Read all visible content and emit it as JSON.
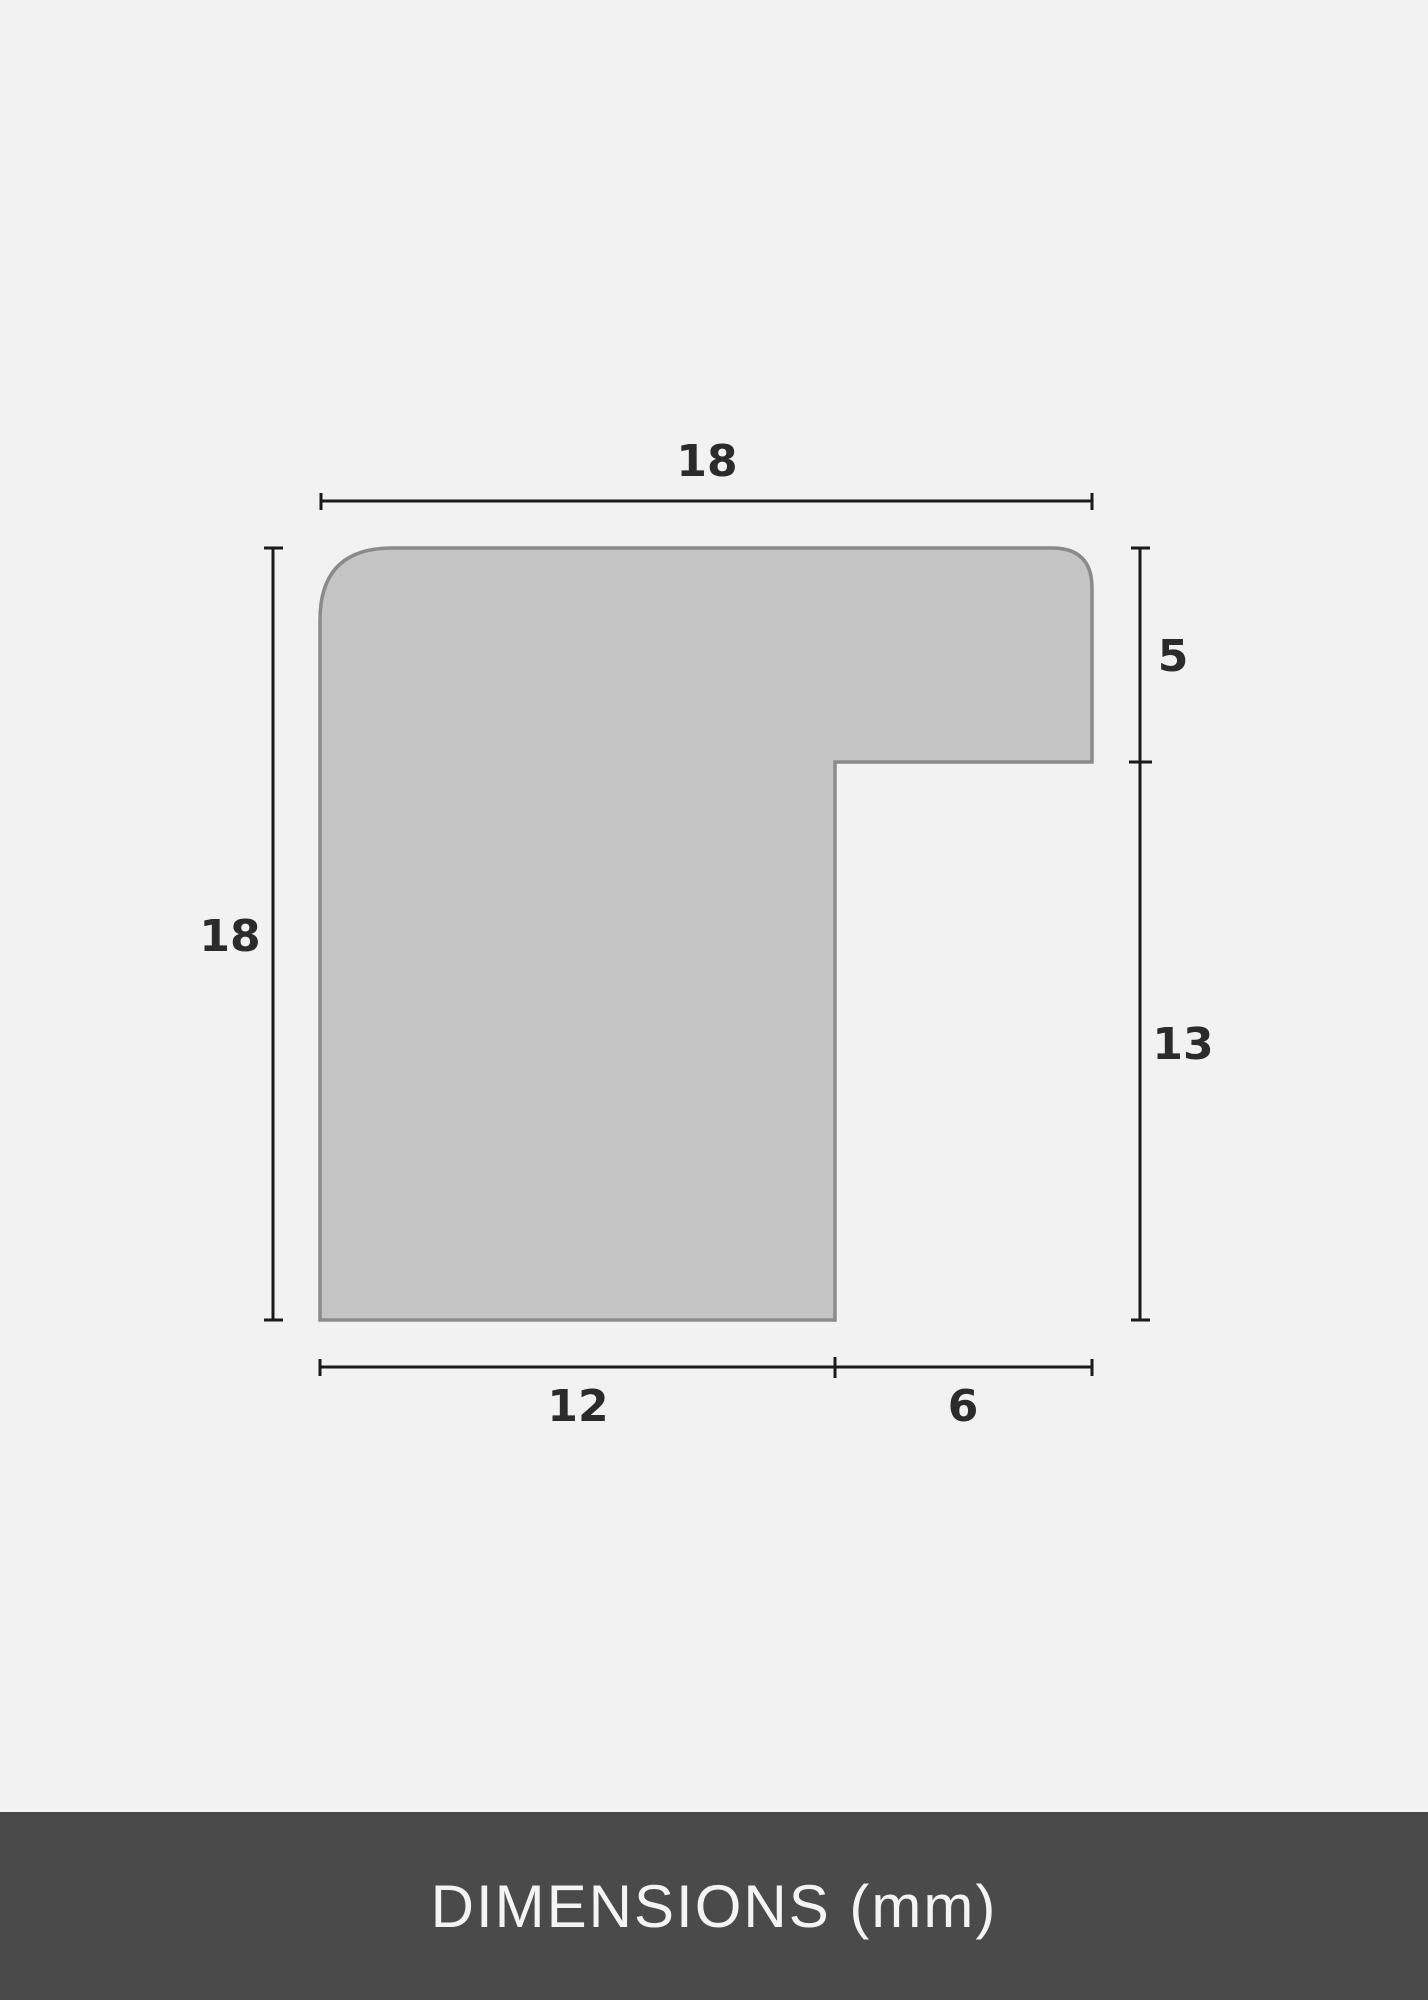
{
  "diagram": {
    "title": "frame moulding profile cross-section",
    "footer_label": "DIMENSIONS (mm)",
    "dimensions": {
      "top_width": "18",
      "left_height": "18",
      "right_upper": "5",
      "right_lower": "13",
      "bottom_left": "12",
      "bottom_right": "6"
    },
    "colors": {
      "background": "#f2f2f2",
      "shape_fill": "#c5c5c5",
      "shape_stroke": "#8b8b8b",
      "dimension_line": "#1a1a1a",
      "label_text": "#2b2b2b",
      "footer_bg": "#4a4a4a",
      "footer_text": "#f4f4f4"
    }
  }
}
